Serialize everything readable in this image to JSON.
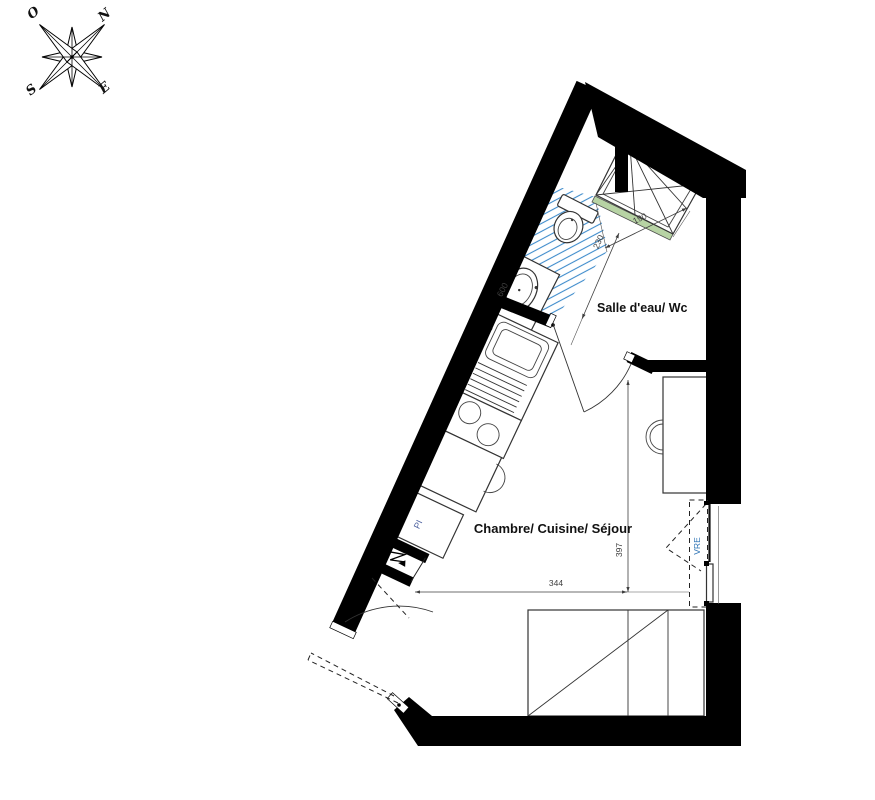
{
  "compass": {
    "west": "O",
    "north": "N",
    "south": "S",
    "east": "E"
  },
  "rooms": {
    "bathroom": "Salle d'eau/ Wc",
    "main": "Chambre/ Cuisine/ Séjour"
  },
  "labels": {
    "closet": "PI",
    "shutter": "VRE"
  },
  "dimensions": {
    "shower_width": "190",
    "bathroom_depth": "230",
    "vanity_width": "600",
    "room_width": "344",
    "room_depth": "397"
  },
  "colors": {
    "wall": "#000000",
    "tile_hatch": "#3f8ccc",
    "sill_green": "#b7d3a4",
    "dimension_text": "#3f3f3f",
    "room_text": "#111111",
    "shutter_text": "#2e74b5",
    "closet_text": "#4a5f9e"
  }
}
